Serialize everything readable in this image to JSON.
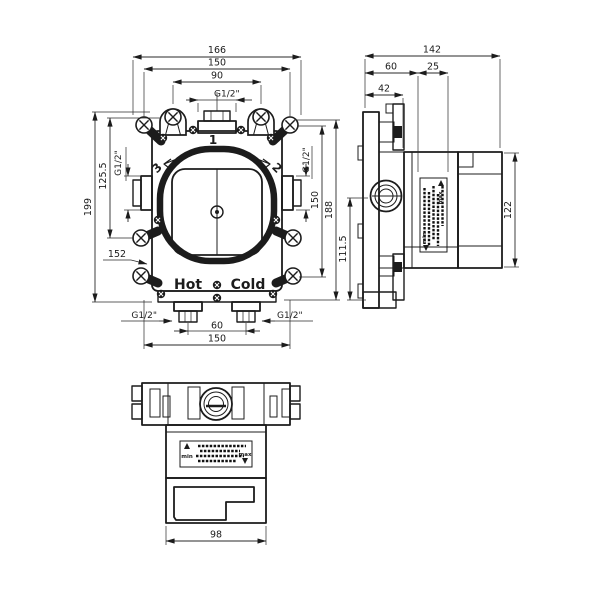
{
  "colors": {
    "background": "#ffffff",
    "line": "#1c1c1c"
  },
  "views": {
    "front": {
      "outlet_numbers": {
        "top": "1",
        "right": "2",
        "left": "3"
      },
      "markings": {
        "hot": "Hot",
        "cold": "Cold"
      },
      "dims": {
        "overall_width": "166",
        "mount_width": "150",
        "top_holes_span": "90",
        "top_outlet_thread": "G1/2\"",
        "overall_height": "199",
        "holes_to_side_outlet": "125.5",
        "ref_152": "152",
        "side_outlet_thread_left": "G1/2\"",
        "side_outlet_thread_right": "G1/2\"",
        "side_holes_span": "150",
        "body_height": "188",
        "inlet_thread_left": "G1/2\"",
        "inlet_thread_right": "G1/2\"",
        "inlet_spacing": "60",
        "bottom_mount_width": "150"
      }
    },
    "side": {
      "dims": {
        "overall_depth": "142",
        "front_depth": "60",
        "trim_zone": "25",
        "flange_depth": "42",
        "lower_height": "111.5",
        "housing_height": "122"
      },
      "sticker": {
        "min": "min",
        "max": "max"
      }
    },
    "bottom": {
      "dims": {
        "housing_width": "98"
      },
      "sticker": {
        "min": "min",
        "max": "max"
      }
    }
  }
}
